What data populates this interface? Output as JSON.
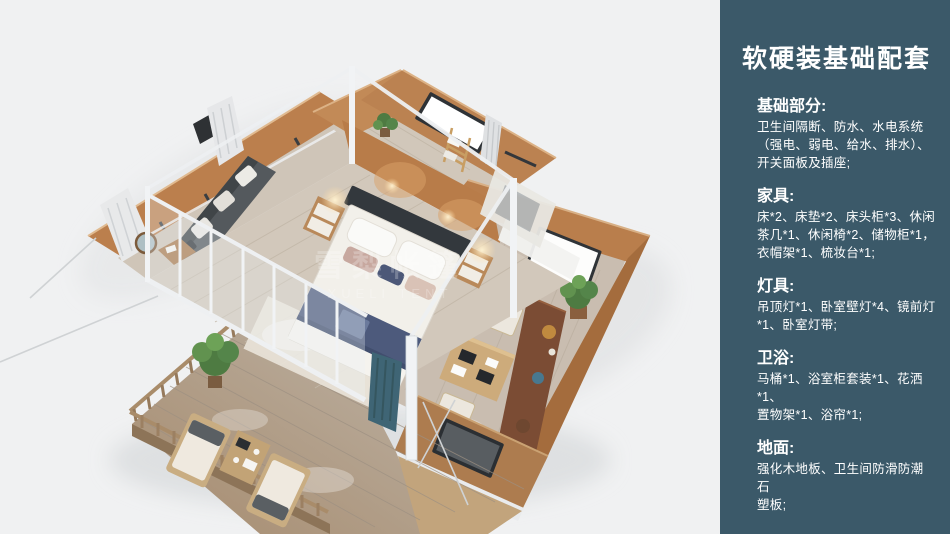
{
  "panel": {
    "title": "软硬装基础配套",
    "background_color": "#3b5969",
    "text_color": "#ffffff",
    "sections": [
      {
        "heading": "基础部分:",
        "lines": [
          "卫生间隔断、防水、水电系统",
          "（强电、弱电、给水、排水）、",
          "开关面板及插座;"
        ]
      },
      {
        "heading": "家具:",
        "lines": [
          "床*2、床垫*2、床头柜*3、休闲",
          "茶几*1、休闲椅*2、储物柜*1，",
          "衣帽架*1、梳妆台*1;"
        ]
      },
      {
        "heading": "灯具:",
        "lines": [
          "吊顶灯*1、卧室壁灯*4、镜前灯",
          "*1、卧室灯带;"
        ]
      },
      {
        "heading": "卫浴:",
        "lines": [
          "马桶*1、浴室柜套装*1、花洒*1、",
          "置物架*1、浴帘*1;"
        ]
      },
      {
        "heading": "地面:",
        "lines": [
          "强化木地板、卫生间防滑防潮石",
          "塑板;"
        ]
      }
    ]
  },
  "illustration": {
    "watermark_cn": "雪梨帐篷",
    "watermark_en": "XUELI TENT",
    "background_color": "#f0f1f2",
    "canvas_wall_color": "#bb8050",
    "deck_wood_color": "#ad9173",
    "bedding_accent_color": "#4d5a7c",
    "curtain_teal_color": "#3f6575",
    "frame_white_color": "#eef0f2"
  }
}
